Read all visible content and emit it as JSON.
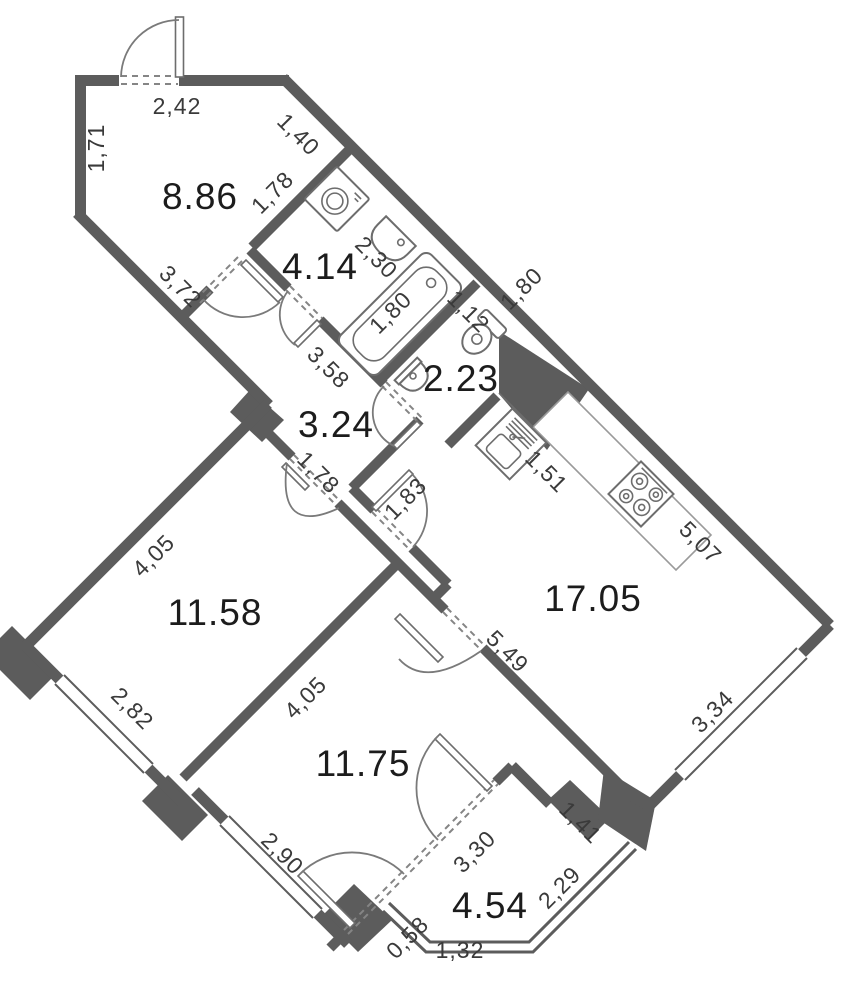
{
  "plan": {
    "title": "apartment-floor-plan",
    "units": "meters",
    "rooms": {
      "entry": "8.86",
      "bathroom": "4.14",
      "wc": "2.23",
      "hall": "3.24",
      "kitchen_living": "17.05",
      "bedroom1": "11.58",
      "bedroom2": "11.75",
      "balcony": "4.54"
    },
    "dims": {
      "top": "2,42",
      "left": "1,71",
      "entry_ne": "1,40",
      "entry_partition": "1,78",
      "entry_sw": "3,72",
      "bath_wall": "2,30",
      "tub": "1,80",
      "wc_side": "1,80",
      "wc_niche": "1,12",
      "hall_ne": "3,58",
      "hall_bed1_door": "1,78",
      "hall_kitchen": "1,83",
      "counter": "1,51",
      "kitchen_ne": "5,07",
      "kitchen_sw": "5,49",
      "kitchen_window": "3,34",
      "bed1_nw": "4,05",
      "bed1_window": "2,82",
      "bed2_nw": "4,05",
      "bed2_window": "2,90",
      "balcony_door": "3,30",
      "balcony_ne": "1,41",
      "balcony_window": "2,29",
      "balcony_bevel": "0,58",
      "balcony_bottom": "1,32"
    },
    "colors": {
      "wall": "#5c5c5c",
      "fixture_line": "#6d6d6d",
      "dim_text": "#3a3a3a",
      "room_text": "#1c1c1c",
      "background": "#ffffff"
    }
  }
}
